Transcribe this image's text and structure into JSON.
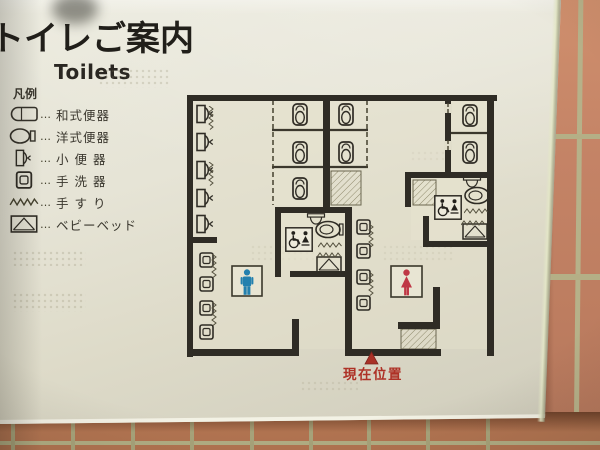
{
  "sign": {
    "title": "トイレご案内",
    "subtitle": "Toilets",
    "legend_title": "凡例",
    "legend_separator": "…",
    "legend": [
      {
        "icon": "squat-toilet-icon",
        "label": "和式便器"
      },
      {
        "icon": "western-toilet-icon",
        "label": "洋式便器"
      },
      {
        "icon": "urinal-icon",
        "label": "小 便 器"
      },
      {
        "icon": "hand-basin-icon",
        "label": "手 洗 器"
      },
      {
        "icon": "handrail-icon",
        "label": "手 す り"
      },
      {
        "icon": "baby-bed-icon",
        "label": "ベビーベッド"
      }
    ],
    "current_location_label": "現在位置"
  },
  "map": {
    "colors": {
      "wall": "#2f2c25",
      "male": "#2380ae",
      "female": "#bf3745",
      "marker": "#a93126",
      "marker_text": "#ae3126"
    },
    "gender_signs": [
      {
        "type": "male",
        "x": 232,
        "y": 266,
        "size": 30
      },
      {
        "type": "female",
        "x": 391,
        "y": 266,
        "size": 31
      }
    ],
    "fixtures": {
      "urinal": [
        {
          "x": 196,
          "y": 104
        },
        {
          "x": 196,
          "y": 132
        },
        {
          "x": 196,
          "y": 160
        },
        {
          "x": 196,
          "y": 188
        },
        {
          "x": 196,
          "y": 214
        }
      ],
      "squat": [
        {
          "x": 292,
          "y": 103
        },
        {
          "x": 292,
          "y": 141
        },
        {
          "x": 292,
          "y": 177
        },
        {
          "x": 338,
          "y": 103
        },
        {
          "x": 338,
          "y": 141
        },
        {
          "x": 462,
          "y": 104
        },
        {
          "x": 462,
          "y": 141
        }
      ],
      "basin": [
        {
          "x": 199,
          "y": 252
        },
        {
          "x": 199,
          "y": 276
        },
        {
          "x": 199,
          "y": 300
        },
        {
          "x": 199,
          "y": 324
        },
        {
          "x": 356,
          "y": 219
        },
        {
          "x": 356,
          "y": 243
        },
        {
          "x": 356,
          "y": 269
        },
        {
          "x": 356,
          "y": 295
        }
      ],
      "western": [
        {
          "x": 315,
          "y": 220
        },
        {
          "x": 464,
          "y": 186
        }
      ],
      "sink": [
        {
          "x": 306,
          "y": 213
        },
        {
          "x": 462,
          "y": 176
        }
      ],
      "bed": [
        {
          "x": 316,
          "y": 256
        },
        {
          "x": 462,
          "y": 223
        }
      ],
      "access": [
        {
          "x": 285,
          "y": 227
        },
        {
          "x": 434,
          "y": 195
        }
      ],
      "rail": [
        {
          "x": 318,
          "y": 242
        },
        {
          "x": 317,
          "y": 252
        },
        {
          "x": 464,
          "y": 208
        },
        {
          "x": 461,
          "y": 220
        },
        {
          "x": 217,
          "y": 254,
          "rot": 90
        },
        {
          "x": 217,
          "y": 302,
          "rot": 90
        },
        {
          "x": 374,
          "y": 224,
          "rot": 90
        },
        {
          "x": 374,
          "y": 272,
          "rot": 90
        },
        {
          "x": 214,
          "y": 106,
          "rot": 90
        },
        {
          "x": 214,
          "y": 162,
          "rot": 90
        }
      ]
    }
  }
}
